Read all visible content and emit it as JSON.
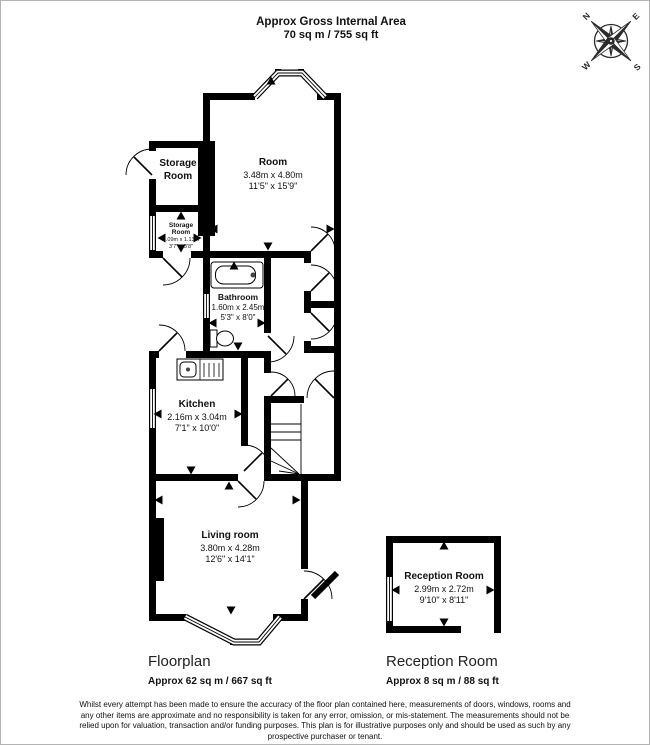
{
  "header": {
    "title": "Approx Gross Internal Area",
    "subtitle": "70 sq m / 755 sq ft"
  },
  "compass": {
    "north": "N",
    "east": "E",
    "south": "S",
    "west": "W"
  },
  "rooms": {
    "main_room": {
      "name": "Room",
      "metric": "3.48m x 4.80m",
      "imperial": "11'5\" x 15'9\""
    },
    "storage_room": {
      "line1": "Storage",
      "line2": "Room"
    },
    "storage_room_small": {
      "line1": "Storage",
      "line2": "Room",
      "metric": "1.09m x 1.13m",
      "imperial": "3'7\" x 3'8\""
    },
    "bathroom": {
      "name": "Bathroom",
      "metric": "1.60m x 2.45m",
      "imperial": "5'3\" x 8'0\""
    },
    "kitchen": {
      "name": "Kitchen",
      "metric": "2.16m x 3.04m",
      "imperial": "7'1\" x 10'0\""
    },
    "living_room": {
      "name": "Living room",
      "metric": "3.80m x 4.28m",
      "imperial": "12'6\" x 14'1\""
    },
    "reception_room": {
      "name": "Reception Room",
      "metric": "2.99m x 2.72m",
      "imperial": "9'10\" x 8'11\""
    }
  },
  "footer": {
    "floorplan_label": "Floorplan",
    "floorplan_area": "Approx 62 sq m / 667 sq ft",
    "reception_label": "Reception Room",
    "reception_area": "Approx 8 sq m / 88 sq ft"
  },
  "disclaimer": "Whilst every attempt has been made to ensure the accuracy of the floor plan contained here, measurements of doors, windows, rooms and any other items are approximate and no responsibility is taken for any error, omission, or mis-statement. The measurements should not be relied upon for valuation, transaction and/or funding purposes. This plan is for illustrative purposes only and should be used as such by any prospective purchaser or tenant.",
  "colors": {
    "wall": "#000000",
    "background": "#ffffff",
    "page_border": "#b3b3b3",
    "compass": "#2b2b2b"
  }
}
